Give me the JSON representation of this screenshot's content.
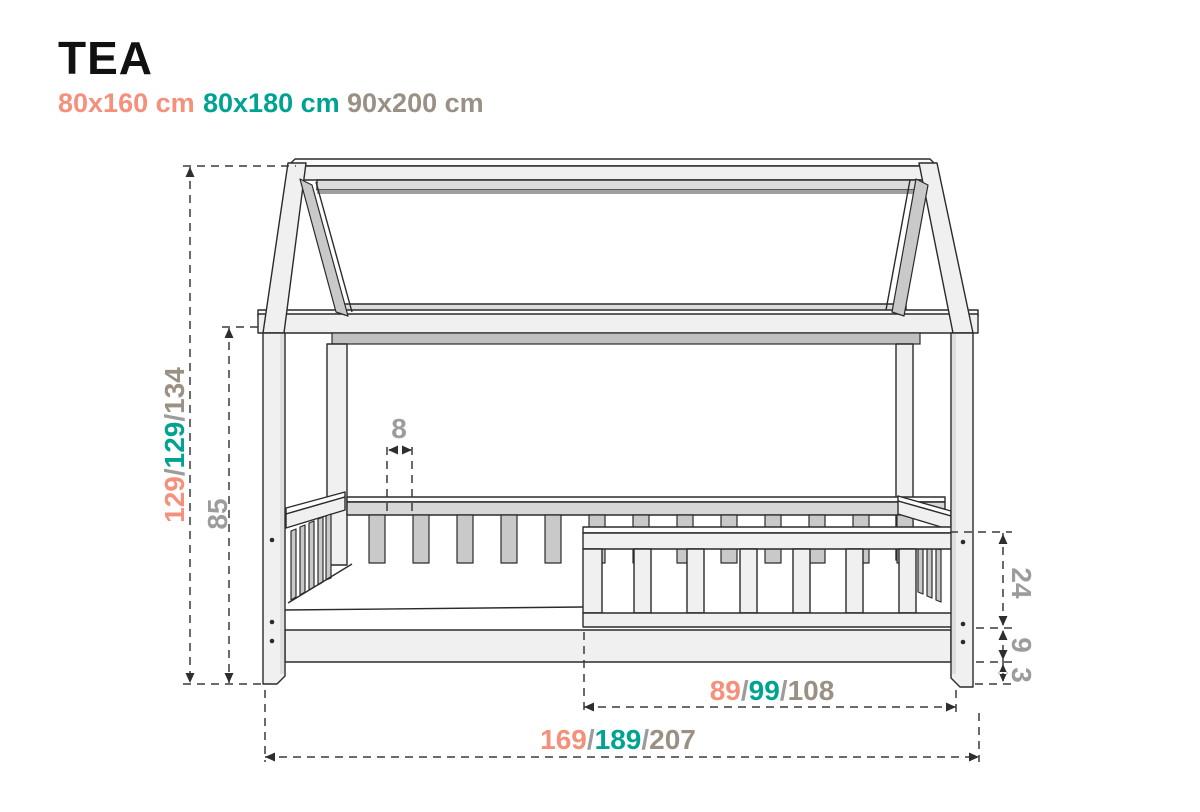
{
  "title": "TEA",
  "sizes": [
    {
      "label": "80x160 cm",
      "color": "#F5907A"
    },
    {
      "label": "80x180 cm",
      "color": "#00A392"
    },
    {
      "label": "90x200 cm",
      "color": "#9A9083"
    }
  ],
  "palette": {
    "salmon": "#F5907A",
    "teal": "#00A392",
    "taupe": "#9A9083",
    "dim_gray": "#9C9C9C",
    "outline": "#2B2B2B"
  },
  "dimensions": {
    "total_height": {
      "parts": [
        {
          "t": "129",
          "c": "#F5907A"
        },
        {
          "t": "/",
          "c": "#9C9C9C"
        },
        {
          "t": "129",
          "c": "#00A392"
        },
        {
          "t": "/",
          "c": "#9C9C9C"
        },
        {
          "t": "134",
          "c": "#9A9083"
        }
      ]
    },
    "wall_height": {
      "value": "85",
      "c": "#9C9C9C"
    },
    "slat_gap": {
      "value": "8",
      "c": "#9C9C9C"
    },
    "guard_rail_height": {
      "value": "24",
      "c": "#9C9C9C"
    },
    "base_height": {
      "value": "9",
      "c": "#9C9C9C"
    },
    "foot_height": {
      "value": "3",
      "c": "#9C9C9C"
    },
    "guard_rail_length": {
      "parts": [
        {
          "t": "89",
          "c": "#F5907A"
        },
        {
          "t": "/",
          "c": "#9C9C9C"
        },
        {
          "t": "99",
          "c": "#00A392"
        },
        {
          "t": "/",
          "c": "#9C9C9C"
        },
        {
          "t": "108",
          "c": "#9A9083"
        }
      ]
    },
    "total_length": {
      "parts": [
        {
          "t": "169",
          "c": "#F5907A"
        },
        {
          "t": "/",
          "c": "#9C9C9C"
        },
        {
          "t": "189",
          "c": "#00A392"
        },
        {
          "t": "/",
          "c": "#9C9C9C"
        },
        {
          "t": "207",
          "c": "#9A9083"
        }
      ]
    }
  }
}
